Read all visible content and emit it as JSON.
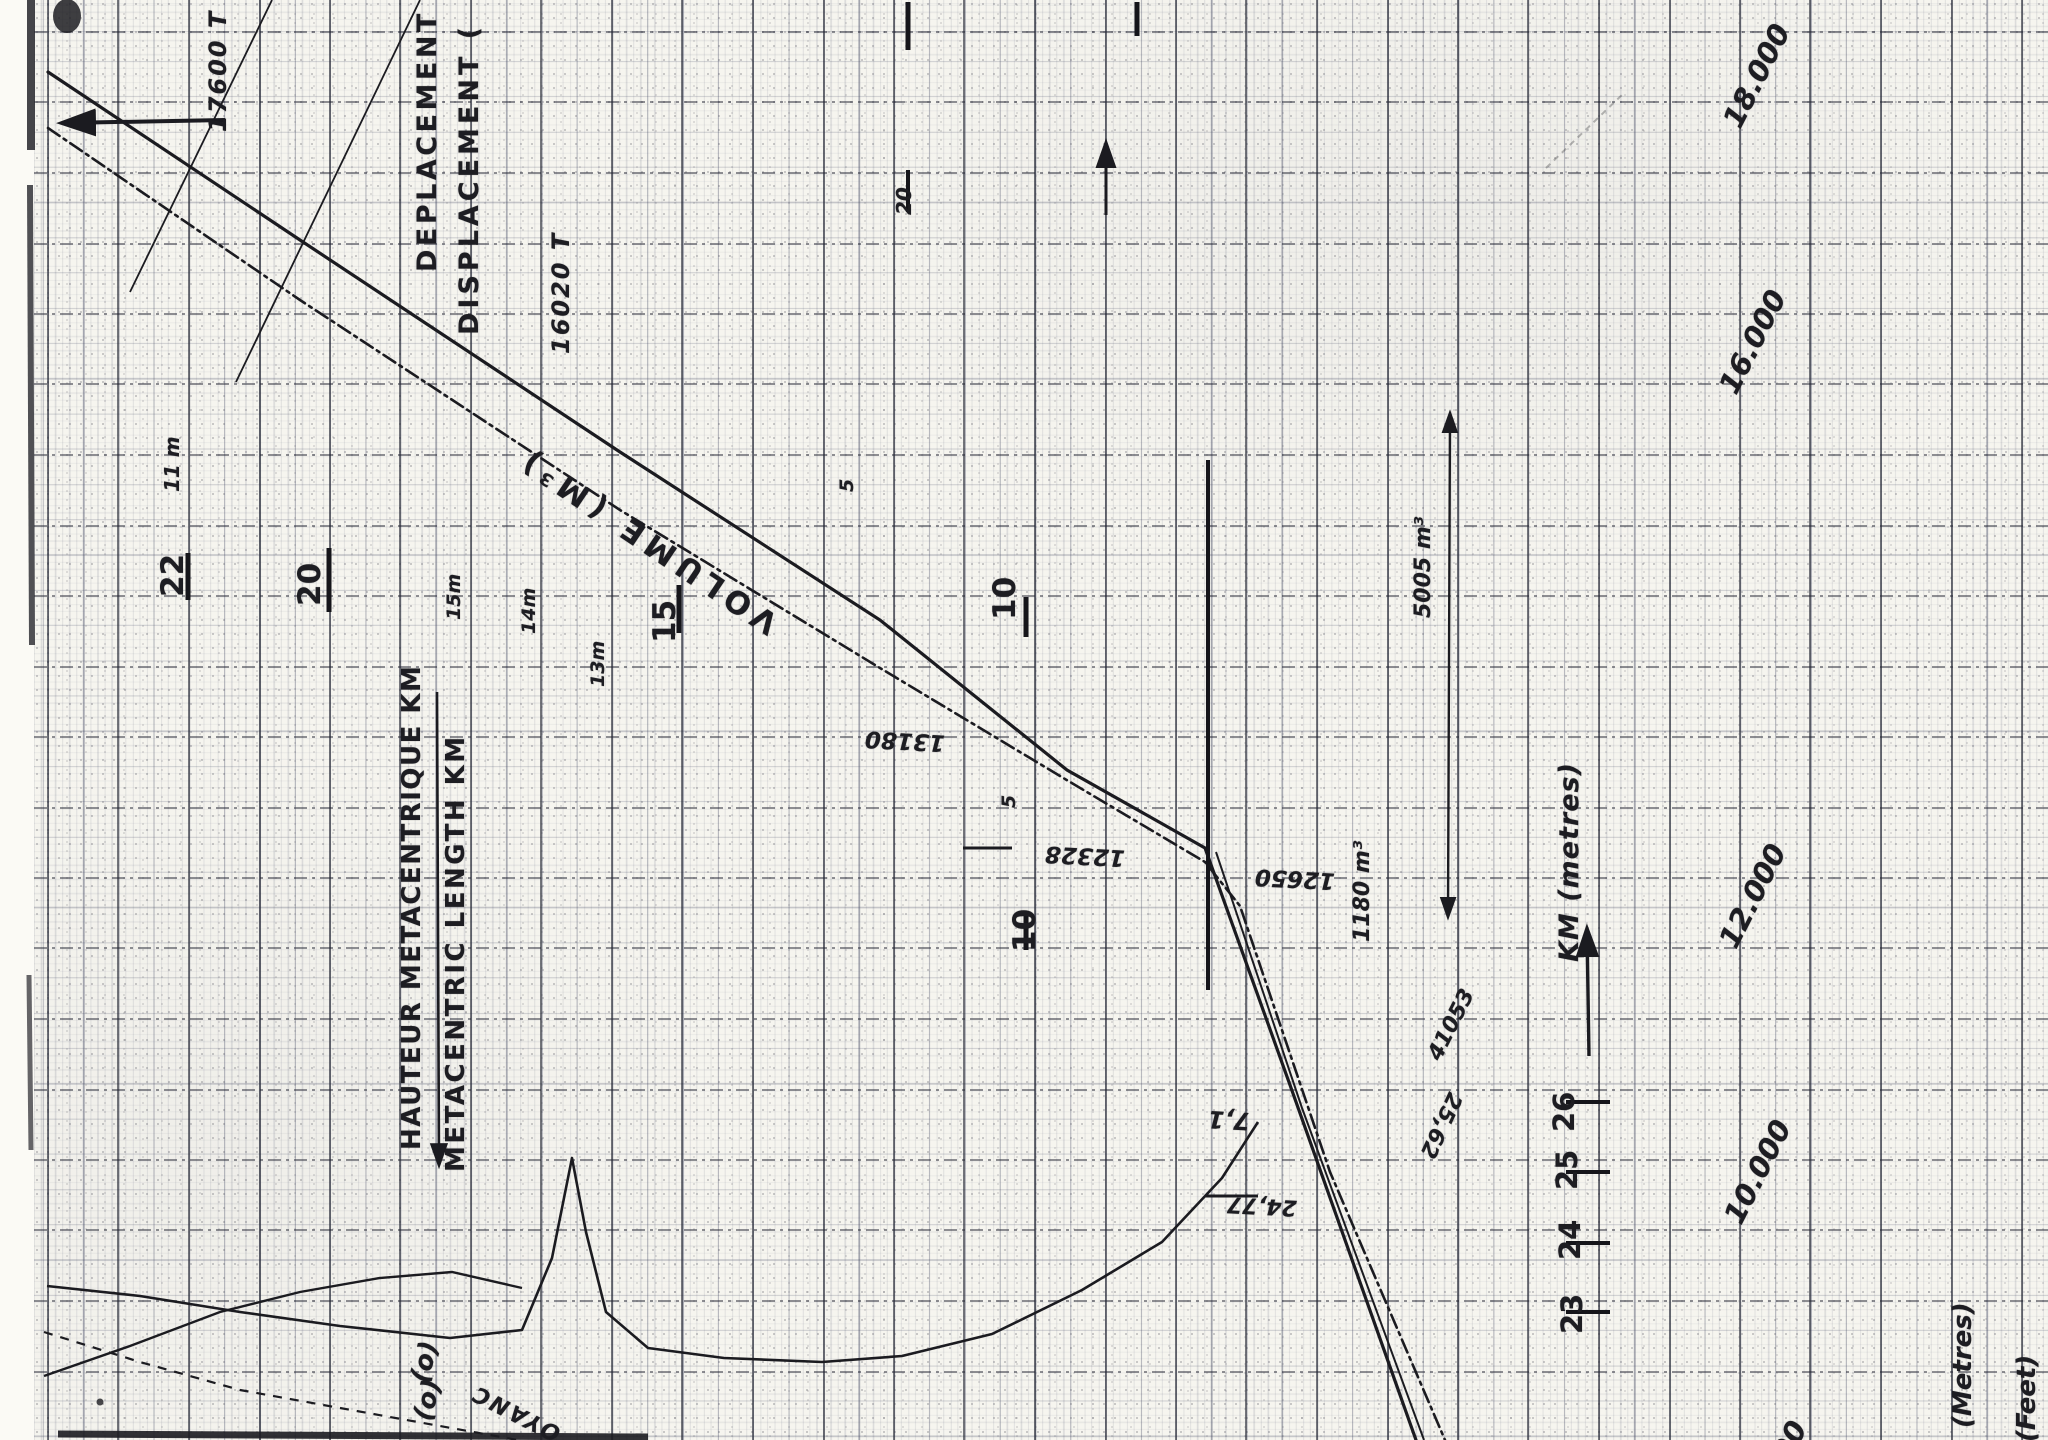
{
  "labels": {
    "title_fr": "DEPLACEMENT EN (",
    "title_en": "DISPLACEMENT (",
    "volume": "VOLUME (M³)",
    "hauteur": "HAUTEUR METACENTRIQUE KM",
    "metacentric": "METACENTRIC LENGTH KM",
    "km_metres": "KM (metres)",
    "metres": "(Metres)",
    "feet": "(Feet)",
    "disp_a": "17600 T",
    "disp_b": "16020 T"
  },
  "annotations": {
    "a13180": "13180",
    "a12328": "12328",
    "a12650": "12650",
    "a1180": "1180 m³",
    "a5005": "5005 m³",
    "a41053": "41053",
    "a2562": "25,62",
    "a2477": "24,77",
    "a71": "7,1",
    "a11m": "11 m",
    "d15": "15m",
    "d14": "14m",
    "d13": "13m",
    "s5a": "5",
    "s5b": "5",
    "s20": "20",
    "b10": "10",
    "p00": "00",
    "o1": "(o)",
    "o2": "(o)",
    "oyanc": "OYANC"
  },
  "axes": {
    "metres": {
      "unit": "m",
      "ticks": [
        {
          "label": "22",
          "value": 22
        },
        {
          "label": "20",
          "value": 20
        },
        {
          "label": "15",
          "value": 15
        },
        {
          "label": "10",
          "value": 10
        }
      ]
    },
    "tonnage": {
      "unit": "t / m³",
      "ticks": [
        {
          "label": "18.000",
          "value": 18000
        },
        {
          "label": "16.000",
          "value": 16000
        },
        {
          "label": "12.000",
          "value": 12000
        },
        {
          "label": "10.000",
          "value": 10000
        }
      ]
    },
    "km_scale": {
      "unit": "m",
      "ticks": [
        {
          "label": "26",
          "value": 26
        },
        {
          "label": "25",
          "value": 25
        },
        {
          "label": "24",
          "value": 24
        },
        {
          "label": "23",
          "value": 23
        }
      ]
    }
  },
  "chart_data": {
    "type": "line",
    "title": "Hydrostatic curves: displacement / volume / metacentric height KM (scanned sheet, rotated 90°, all text reads bottom-to-top)",
    "coordinate_space": "scan pixels, 2048x1440",
    "axis_ranges": {
      "metacentric_km_m": [
        10,
        22
      ],
      "displacement_t": [
        10000,
        18000
      ],
      "km_scale_m": [
        23,
        26
      ]
    },
    "tick_positions": {
      "metres_x_at_y597": {
        "22": 188,
        "20": 329,
        "15": 679,
        "10": 1026
      },
      "tonnage_y_at_right_edge": {
        "18000": 63,
        "16000": 350,
        "12000": 893,
        "10000": 1173
      },
      "km_scale_y_at_x1600": {
        "26": 1102,
        "25": 1172,
        "24": 1243,
        "23": 1312
      }
    },
    "series": [
      {
        "name": "displacement-line",
        "style": "solid",
        "points": "48,72 300,240 620,452 880,620 1067,770 1205,848 1290,1085 1416,1440"
      },
      {
        "name": "volume-line",
        "style": "dash-dot",
        "points": "48,128 300,300 620,510 880,668 1070,782 1205,862 1240,906 1330,1172 1445,1440"
      },
      {
        "name": "displacement-line-secondary",
        "style": "solid-thin",
        "points": "1216,852 1302,1108 1424,1440"
      },
      {
        "name": "km-metacentric-curve",
        "style": "solid",
        "points": "47,1286 140,1296 240,1312 340,1326 450,1338 522,1330 552,1258 572,1158 586,1232 606,1312 648,1348 724,1358 822,1362 902,1356 992,1334 1082,1290 1162,1242 1222,1178 1258,1122"
      },
      {
        "name": "secondary-curve",
        "style": "solid",
        "points": "44,1376 130,1346 220,1312 300,1292 380,1278 452,1272 522,1288"
      },
      {
        "name": "buoyancy-dashed-line",
        "style": "dashed",
        "points": "44,1332 140,1362 240,1390 340,1408 440,1426 562,1448"
      },
      {
        "name": "aux-line-1",
        "style": "thin",
        "points": "272,0 130,292"
      },
      {
        "name": "aux-line-2",
        "style": "thin",
        "points": "420,0 236,382"
      }
    ],
    "guides": {
      "v1": {
        "points": "1208,460 1208,990"
      },
      "lvl1": {
        "points": "963,848 1012,848"
      },
      "lvl2": {
        "points": "1205,1196 1258,1196"
      },
      "tick22": {
        "points": "188,553 188,600"
      },
      "tick20": {
        "points": "329,548 329,612"
      },
      "tick15": {
        "points": "679,585 679,633"
      },
      "tick10": {
        "points": "1026,597 1026,637"
      },
      "tick10b": {
        "points": "1026,915 1026,950"
      },
      "tick20q": {
        "points": "908,170 908,212"
      },
      "dasha": {
        "points": "1137,2 1137,36"
      },
      "dashb": {
        "points": "908,2 908,50"
      },
      "kmt1": {
        "points": "1566,1102 1610,1102"
      },
      "kmt2": {
        "points": "1566,1172 1610,1172"
      },
      "kmt3": {
        "points": "1566,1243 1610,1243"
      },
      "kmt4": {
        "points": "1566,1312 1610,1312"
      }
    },
    "arrows": {
      "left_arrow": {
        "points": "225,120 64,123"
      },
      "up_arrow": {
        "points": "1106,215 1106,144"
      },
      "dim_arrow": {
        "points": "1450,414 1448,916"
      },
      "labels_arrow": {
        "points": "437,692 439,1164"
      },
      "km_scale_arrow": {
        "points": "1589,1056 1587,930"
      }
    },
    "legend": "none",
    "grid": "millimeter graph paper, heavy line every 70.5px (1 cm)"
  }
}
